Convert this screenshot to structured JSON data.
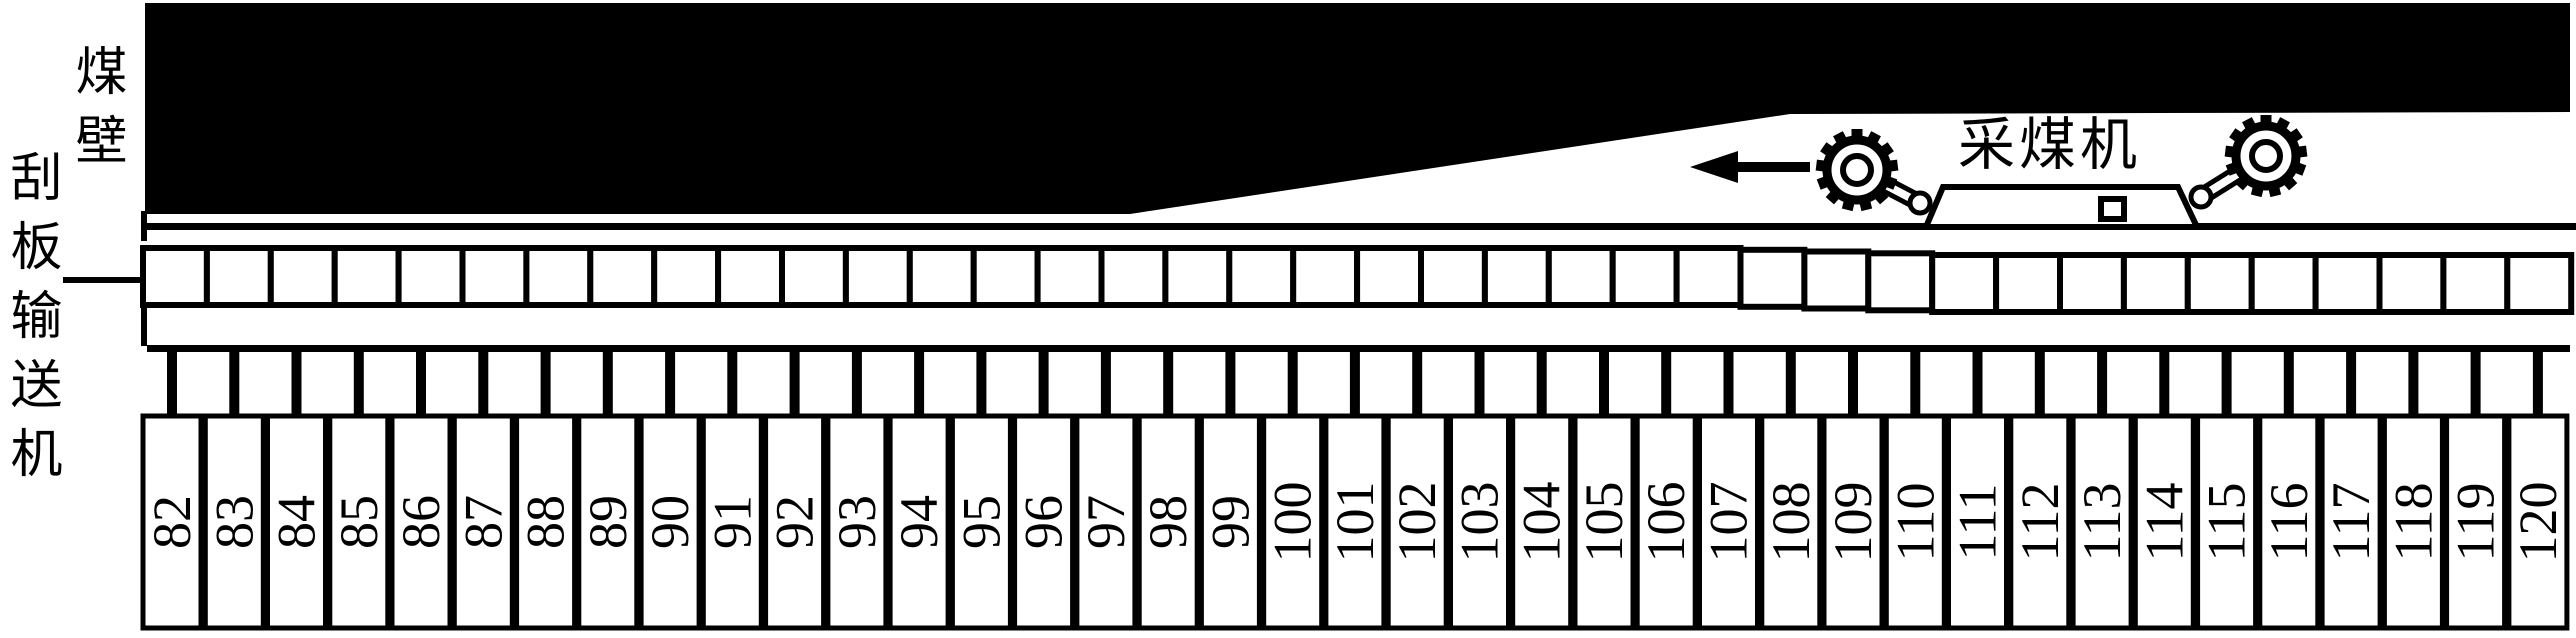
{
  "labels": {
    "coal_wall": "煤壁",
    "conveyor": "刮板输送机",
    "shearer": "采煤机"
  },
  "supports": {
    "numbers": [
      "82",
      "83",
      "84",
      "85",
      "86",
      "87",
      "88",
      "89",
      "90",
      "91",
      "92",
      "93",
      "94",
      "95",
      "96",
      "97",
      "98",
      "99",
      "100",
      "101",
      "102",
      "103",
      "104",
      "105",
      "106",
      "107",
      "108",
      "109",
      "110",
      "111",
      "112",
      "113",
      "114",
      "115",
      "116",
      "117",
      "118",
      "119",
      "120"
    ]
  },
  "colors": {
    "ink": "#000000",
    "background": "#ffffff"
  }
}
